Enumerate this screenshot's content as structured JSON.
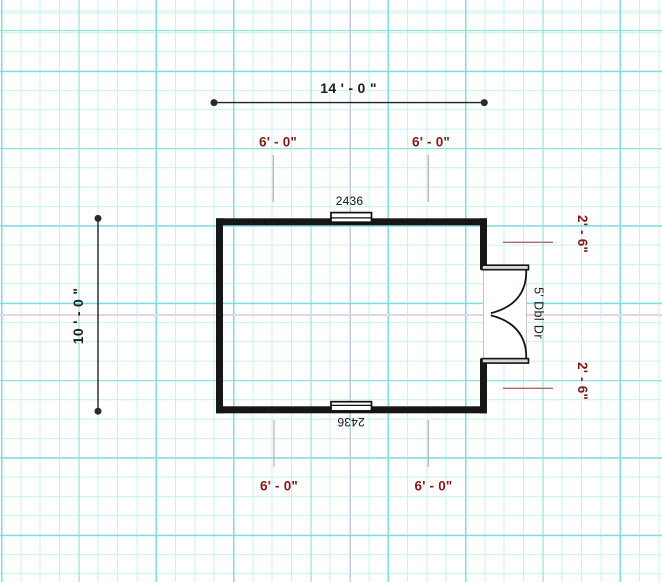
{
  "plan": {
    "overall_width_label": "14 ' - 0 \"",
    "overall_height_label": "10 ' - 0 \"",
    "window_offset_top_left": "6' - 0\"",
    "window_offset_top_right": "6' - 0\"",
    "window_offset_bottom_left": "6' - 0\"",
    "window_offset_bottom_right": "6' - 0\"",
    "door_offset_top": "2' - 6\"",
    "door_offset_bottom": "2' - 6\"",
    "window_top_label": "2436",
    "window_bottom_label": "2436",
    "door_label": "5' Dbl Dr"
  },
  "colors": {
    "offset_text": "#851818",
    "dimension_text": "#1c1c1c",
    "wall": "#161616",
    "grid_minor": "#c9f1f1",
    "grid_major": "#7edede",
    "axis_vertical": "#bfcade",
    "axis_horizontal": "#e6d4e4",
    "leader_gray": "#b3b3b3",
    "leader_red": "#aa6a6a",
    "jamb_fill": "#d8d8d8"
  }
}
